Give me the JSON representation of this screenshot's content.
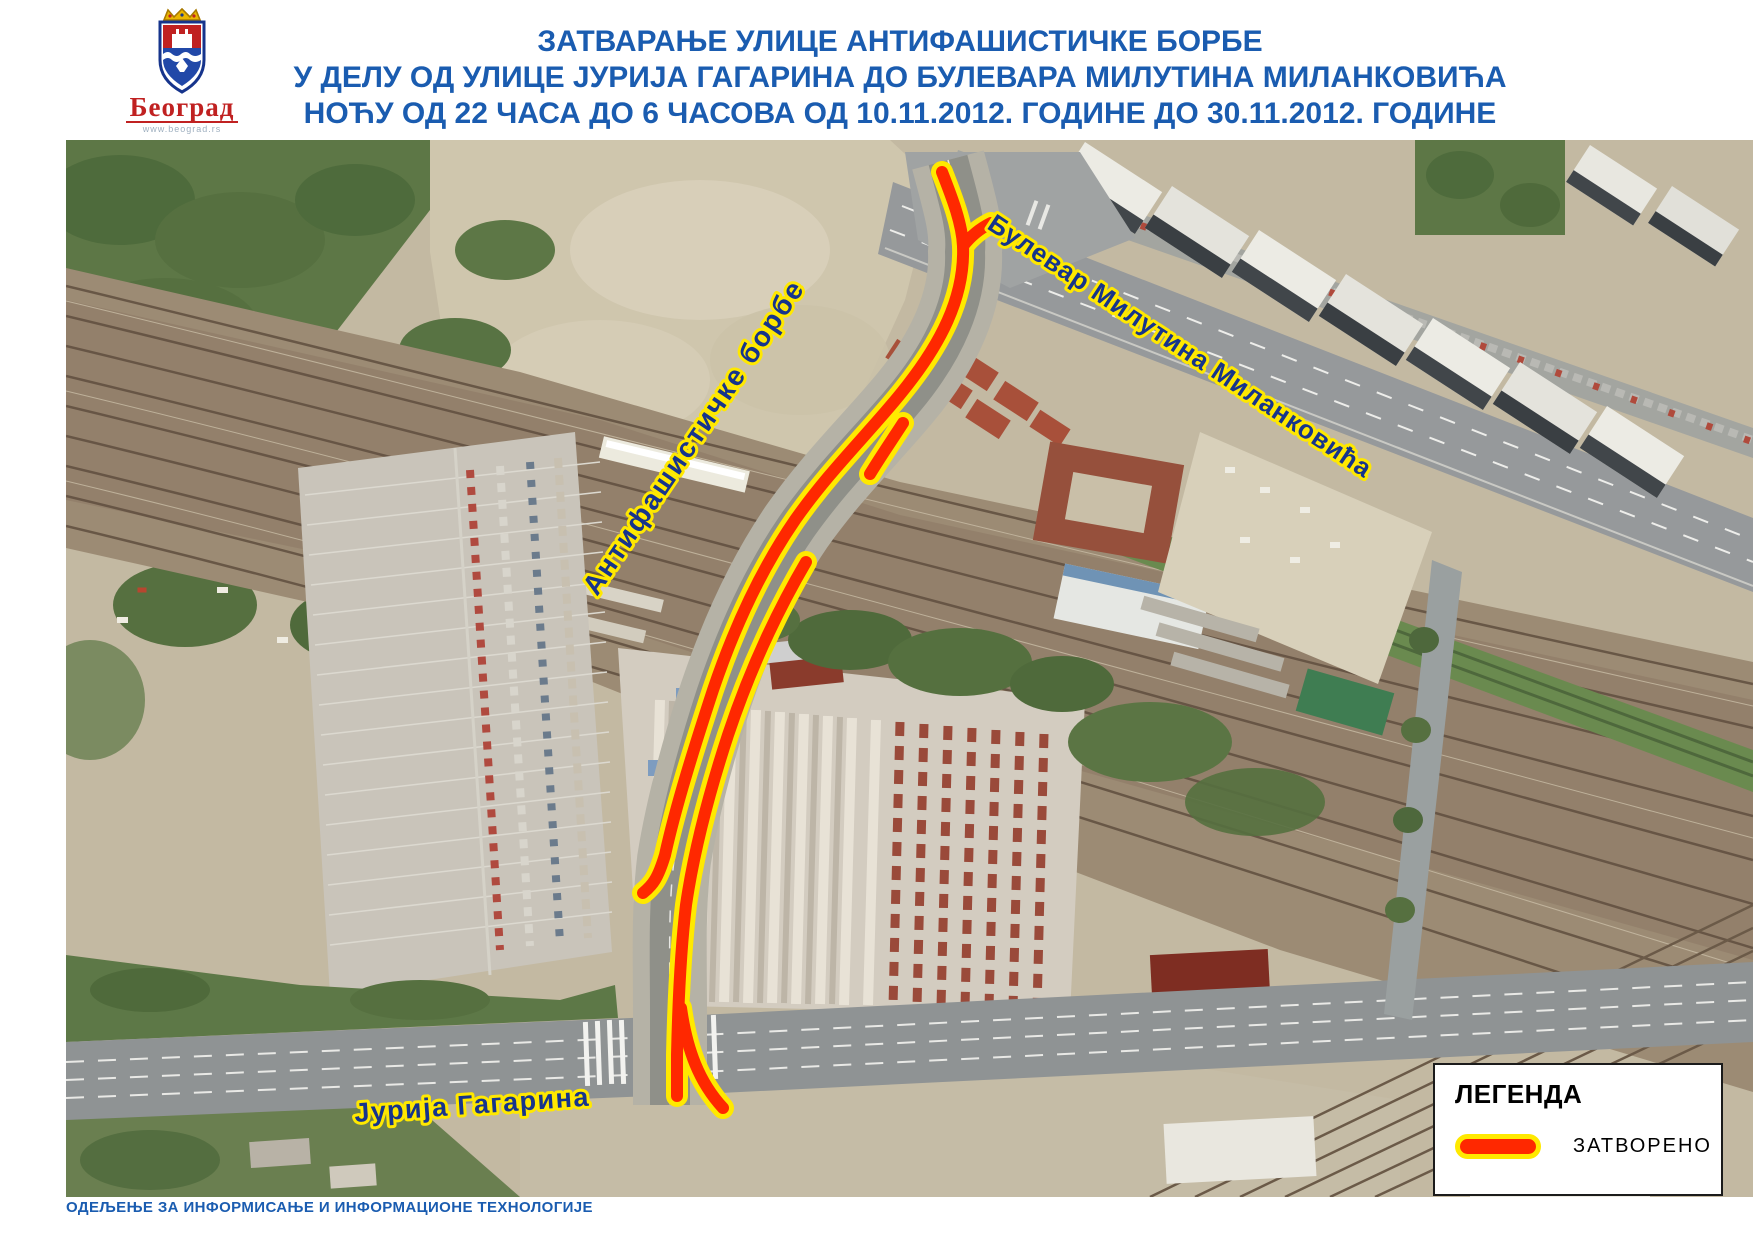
{
  "header": {
    "logo": {
      "city_name": "Београд",
      "city_url": "www.beograd.rs",
      "org_name": "СЕКРЕТАРИЈАТ ЗА САОБРАЋАЈ",
      "org_url": "www.bgsaobracaj.rs"
    },
    "title_line1": "ЗАТВАРАЊЕ УЛИЦЕ АНТИФАШИСТИЧКЕ БОРБЕ",
    "title_line2": "У ДЕЛУ ОД УЛИЦЕ ЈУРИЈА ГАГАРИНА ДО БУЛЕВАРА МИЛУТИНА МИЛАНКОВИЋА",
    "title_line3": "НОЋУ ОД 22 ЧАСА ДО 6 ЧАСОВА ОД 10.11.2012. ГОДИНЕ ДО 30.11.2012. ГОДИНЕ"
  },
  "map": {
    "street_labels": {
      "boulevard": "Булевар Милутина Миланковића",
      "closed_street": "Антифашистичке борбе",
      "bottom_street": "Јурија Гагарина"
    }
  },
  "legend": {
    "title": "ЛЕГЕНДА",
    "closed_label": "ЗАТВОРЕНО"
  },
  "footer": {
    "department": "ОДЕЉЕЊЕ ЗА ИНФОРМИСАЊЕ И ИНФОРМАЦИОНЕ ТЕХНОЛОГИЈЕ"
  },
  "colors": {
    "title_blue": "#1a5cb0",
    "street_label_blue": "#16348c",
    "street_label_outline": "#ffe800",
    "closure_red": "#ff2800",
    "closure_outline": "#ffe900",
    "city_red": "#c02121"
  }
}
